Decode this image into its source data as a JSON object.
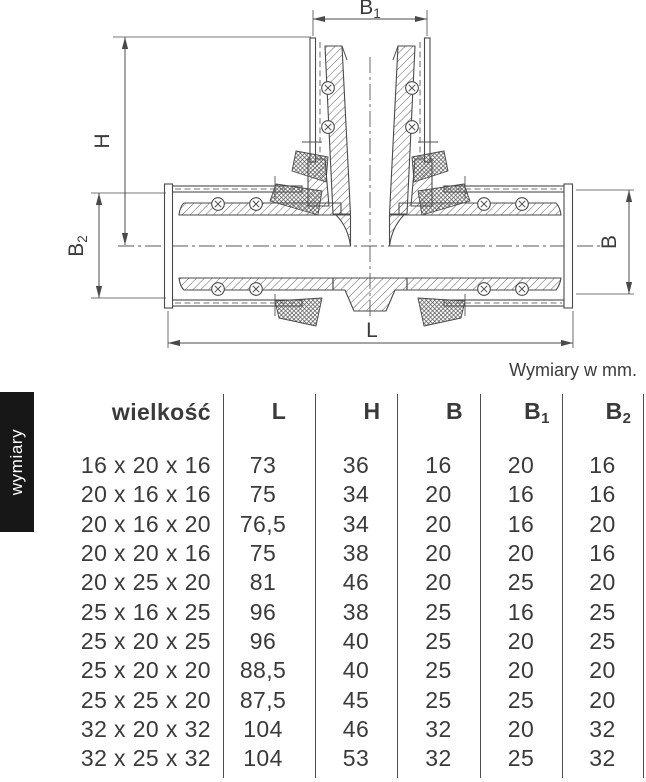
{
  "diagram": {
    "labels": {
      "b1": {
        "base": "B",
        "sub": "1"
      },
      "h": {
        "base": "H",
        "sub": ""
      },
      "b2": {
        "base": "B",
        "sub": "2"
      },
      "b": {
        "base": "B",
        "sub": ""
      },
      "l": {
        "base": "L",
        "sub": ""
      }
    },
    "caption": "Wymiary w mm."
  },
  "sidebar": {
    "label": "wymiary"
  },
  "table": {
    "size_header": "wielkość",
    "columns": [
      {
        "base": "L",
        "sub": ""
      },
      {
        "base": "H",
        "sub": ""
      },
      {
        "base": "B",
        "sub": ""
      },
      {
        "base": "B",
        "sub": "1"
      },
      {
        "base": "B",
        "sub": "2"
      }
    ],
    "rows": [
      {
        "size": "16 x 20 x 16",
        "L": "73",
        "H": "36",
        "B": "16",
        "B1": "20",
        "B2": "16"
      },
      {
        "size": "20 x 16 x 16",
        "L": "75",
        "H": "34",
        "B": "20",
        "B1": "16",
        "B2": "16"
      },
      {
        "size": "20 x 16 x 20",
        "L": "76,5",
        "H": "34",
        "B": "20",
        "B1": "16",
        "B2": "20"
      },
      {
        "size": "20 x 20 x 16",
        "L": "75",
        "H": "38",
        "B": "20",
        "B1": "20",
        "B2": "16"
      },
      {
        "size": "20 x 25 x 20",
        "L": "81",
        "H": "46",
        "B": "20",
        "B1": "25",
        "B2": "20"
      },
      {
        "size": "25 x 16 x 25",
        "L": "96",
        "H": "38",
        "B": "25",
        "B1": "16",
        "B2": "25"
      },
      {
        "size": "25 x 20 x 25",
        "L": "96",
        "H": "40",
        "B": "25",
        "B1": "20",
        "B2": "25"
      },
      {
        "size": "25 x 20 x 20",
        "L": "88,5",
        "H": "40",
        "B": "25",
        "B1": "20",
        "B2": "20"
      },
      {
        "size": "25 x 25 x 20",
        "L": "87,5",
        "H": "45",
        "B": "25",
        "B1": "25",
        "B2": "20"
      },
      {
        "size": "32 x 20 x 32",
        "L": "104",
        "H": "46",
        "B": "32",
        "B1": "20",
        "B2": "32"
      },
      {
        "size": "32 x 25 x 32",
        "L": "104",
        "H": "53",
        "B": "32",
        "B1": "25",
        "B2": "32"
      }
    ]
  }
}
